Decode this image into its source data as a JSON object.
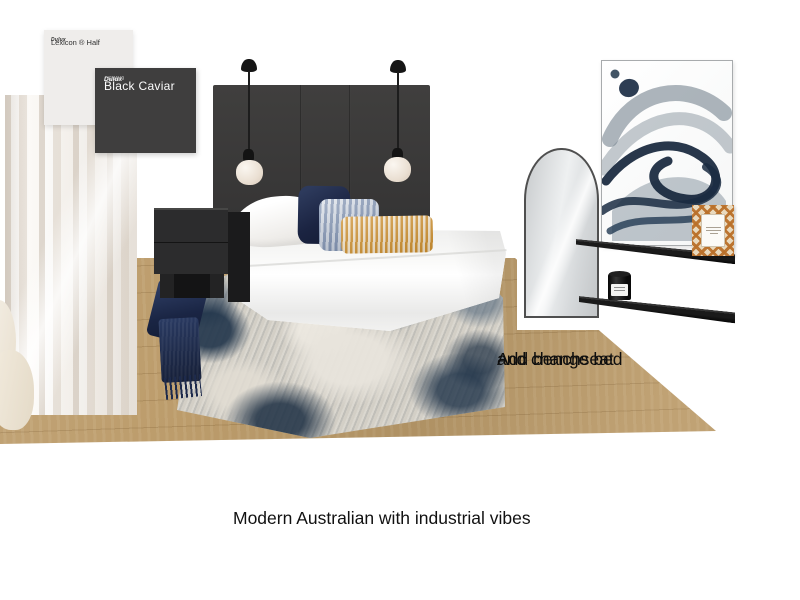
{
  "board": {
    "caption": "Modern Australian with industrial vibes",
    "note_line1": "Add benchseat",
    "note_line2": "and change bed"
  },
  "swatches": {
    "light": {
      "brand": "Dulux",
      "name": "Lexicon ® Half"
    },
    "dark": {
      "brand": "Dulux",
      "code": "SN4H9",
      "name": "Black Caviar"
    }
  },
  "colors": {
    "background": "#ffffff",
    "wood_floor": "#bc9c6b",
    "headboard_charcoal": "#3a3938",
    "swatch_dark": "#3f3e3e",
    "swatch_light": "#efedeb",
    "navy": "#1b2442",
    "slate_blue": "#5b6e80",
    "mustard": "#cd9030",
    "rug_ivory": "#d3cfc6",
    "curtain_ivory": "#f2eee9"
  }
}
